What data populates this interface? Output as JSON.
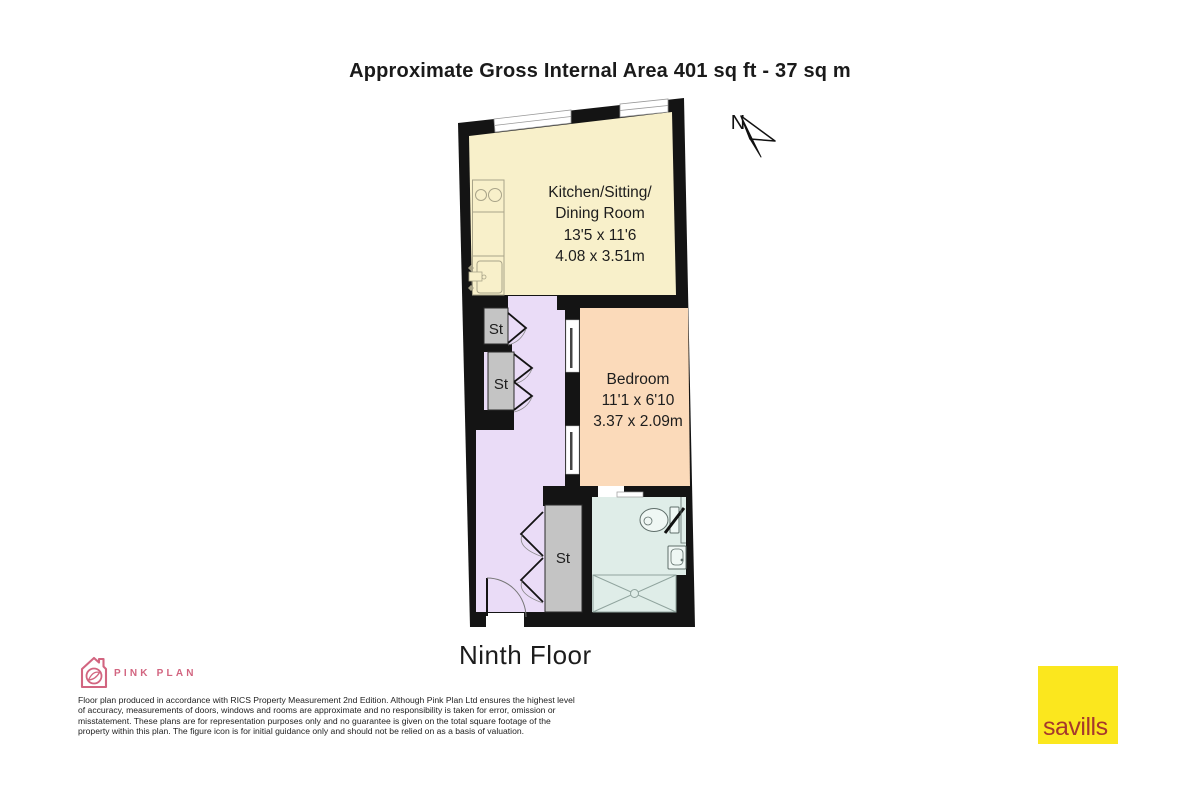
{
  "title": "Approximate Gross Internal Area 401 sq ft - 37 sq m",
  "floor_label": "Ninth Floor",
  "compass": {
    "label": "N"
  },
  "plan": {
    "wall_color": "#141414",
    "rooms": {
      "kitchen": {
        "line1": "Kitchen/Sitting/",
        "line2": "Dining Room",
        "imperial": "13'5 x 11'6",
        "metric": "4.08 x 3.51m",
        "color": "#F8F0CA"
      },
      "bedroom": {
        "name": "Bedroom",
        "imperial": "11'1 x 6'10",
        "metric": "3.37 x 2.09m",
        "color": "#FBDABA"
      },
      "hall": {
        "color": "#EADCF7"
      },
      "bathroom": {
        "color": "#DFEDE8"
      },
      "storage": {
        "label": "St",
        "color": "#C4C4C4"
      }
    }
  },
  "footer": {
    "brand_name": "PINK PLAN",
    "brand_color": "#D26580",
    "disclaimer": "Floor plan produced in accordance with RICS Property Measurement 2nd Edition. Although Pink Plan Ltd ensures the highest level of accuracy, measurements of doors, windows and rooms are approximate and no responsibility is taken for error, omission or misstatement. These plans are for representation purposes only and no guarantee is given on the total square footage of the property within this plan. The figure icon is for initial guidance only and should not be relied on as a basis of valuation.",
    "agent": {
      "name": "savills",
      "bg_color": "#FBE71E",
      "text_color": "#A6392C"
    }
  }
}
